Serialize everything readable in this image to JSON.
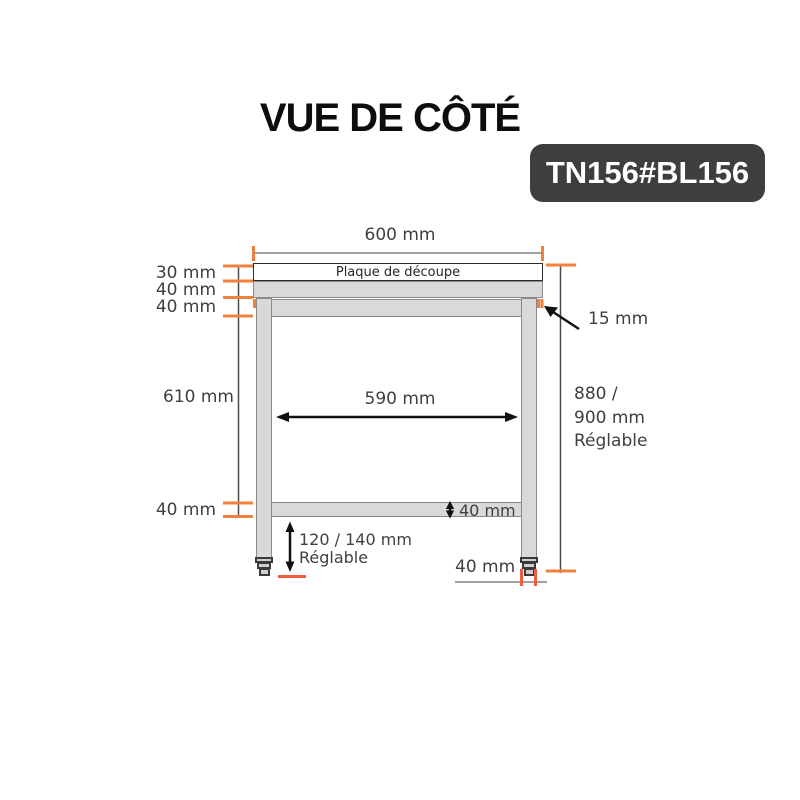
{
  "title": "VUE DE CÔTÉ",
  "badge": "TN156#BL156",
  "colors": {
    "accent_orange": "#F0813D",
    "accent_red": "#F15B40",
    "steel_fill": "#D9D9D9",
    "steel_border": "#8A8A8A",
    "line_gray": "#808080",
    "ink": "#3F3F3F",
    "badge_bg": "#3E3E3E",
    "badge_text": "#FFFFFF"
  },
  "diagram": {
    "top_width": "600 mm",
    "plaque_label": "Plaque de découpe",
    "left_dims": [
      "30 mm",
      "40 mm",
      "40 mm"
    ],
    "overhang": "15 mm",
    "leg_height": "610 mm",
    "inner_width": "590 mm",
    "total_height": [
      "880 /",
      "900 mm",
      "Réglable"
    ],
    "shelf_left": "40 mm",
    "shelf_thickness": "40 mm",
    "foot_height_line1": "120 / 140 mm",
    "foot_height_line2": "Réglable",
    "foot_width": "40 mm"
  }
}
